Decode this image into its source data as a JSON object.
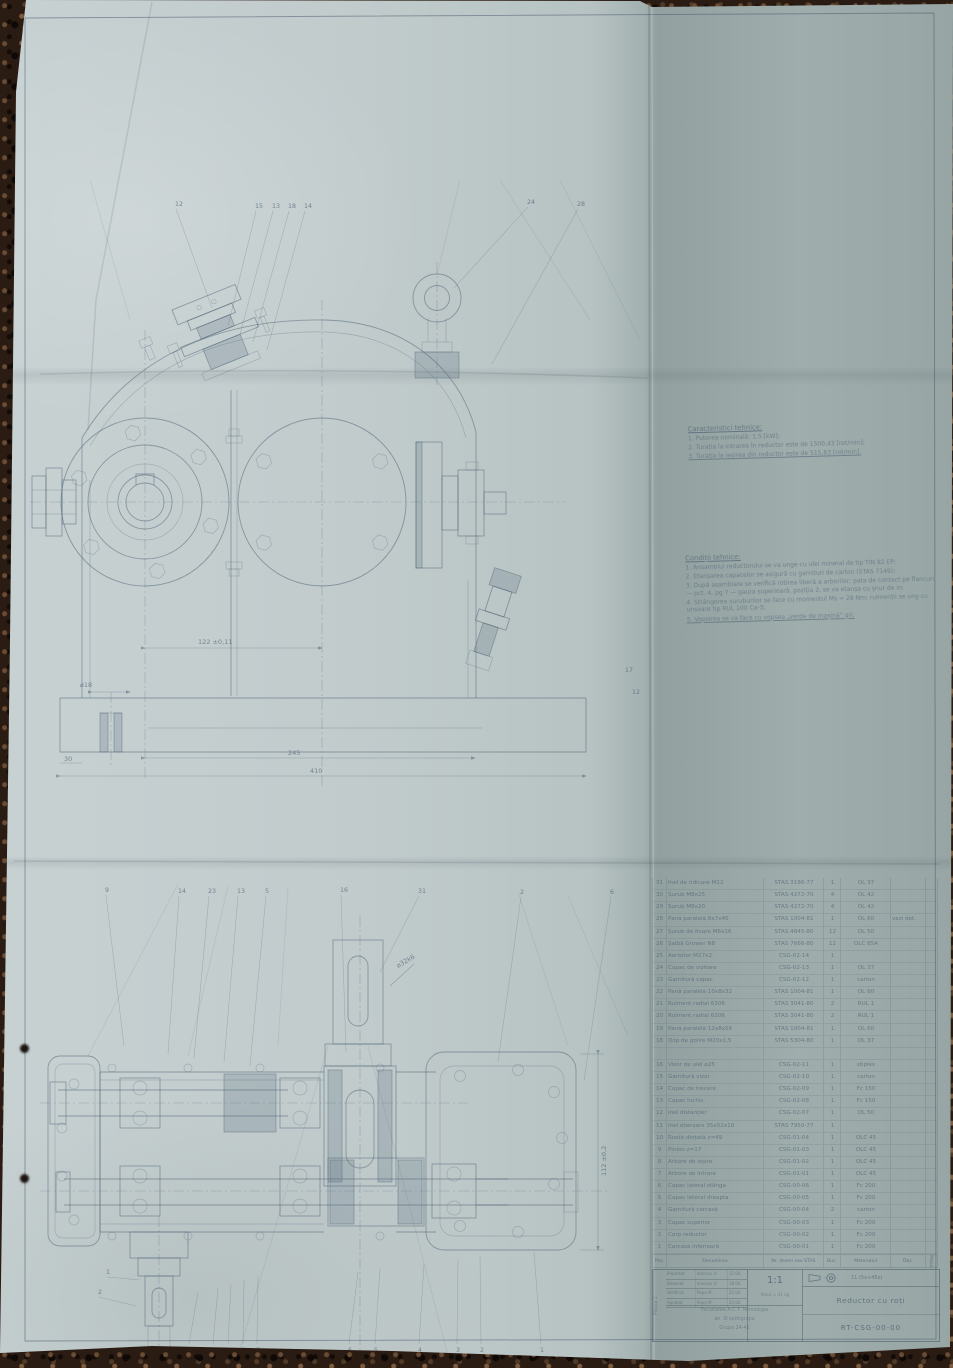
{
  "notes": {
    "characteristics": {
      "title": "Caracteristici tehnice:",
      "items": [
        "1. Puterea nominală: 1,5 [kW];",
        "2. Turația la intrarea în reductor este de 1500,43 [rot/min];",
        "3. Turația la ieșirea din reductor este de 515,63 [rot/min]."
      ]
    },
    "conditions": {
      "title": "Condiții tehnice:",
      "items": [
        "1. Ansamblul reductorului se va unge cu ulei mineral de tip TIN 82 EP;",
        "2. Etanșarea capacelor se asigură cu garnituri de carton (STAS 7149);",
        "3. După asamblare se verifică rotirea liberă a arborilor; pata de contact pe flancuri — pct. 4, pg 7 — gaura superioară, poziția 2, se va etanșa cu șnur de in;",
        "4. Strângerea șuruburilor se face cu momentul Ms = 28 Nm; rulmenții se ung cu unsoare tip RUL 100 Ca-3;",
        "5. Vopsirea se va face cu vopsea „verde de mașină” gri."
      ]
    }
  },
  "front_view": {
    "callouts": [
      {
        "n": "12",
        "x": 145,
        "y": 26,
        "tx": 182,
        "ty": 128
      },
      {
        "n": "15",
        "x": 225,
        "y": 28,
        "tx": 198,
        "ty": 146
      },
      {
        "n": "13",
        "x": 242,
        "y": 28,
        "tx": 210,
        "ty": 154
      },
      {
        "n": "18",
        "x": 258,
        "y": 28,
        "tx": 223,
        "ty": 162
      },
      {
        "n": "14",
        "x": 274,
        "y": 28,
        "tx": 237,
        "ty": 170
      },
      {
        "n": "24",
        "x": 497,
        "y": 24,
        "tx": 424,
        "ty": 108
      },
      {
        "n": "28",
        "x": 547,
        "y": 26,
        "tx": 462,
        "ty": 184
      },
      {
        "n": "17",
        "x": 595,
        "y": 492
      },
      {
        "n": "12",
        "x": 602,
        "y": 514
      }
    ],
    "dims": {
      "center_distance": "122 ±0,11",
      "foot_hole": "⌀18",
      "base_inner": "245",
      "base_total": "410",
      "foot_offset": "30"
    }
  },
  "section_view": {
    "callouts_top": [
      {
        "n": "9",
        "x": 77,
        "y": 16,
        "tx": 96,
        "ty": 170
      },
      {
        "n": "14",
        "x": 150,
        "y": 17,
        "tx": 140,
        "ty": 178
      },
      {
        "n": "23",
        "x": 180,
        "y": 17,
        "tx": 166,
        "ty": 182
      },
      {
        "n": "13",
        "x": 209,
        "y": 17,
        "tx": 196,
        "ty": 186
      },
      {
        "n": "5",
        "x": 237,
        "y": 17,
        "tx": 222,
        "ty": 190
      },
      {
        "n": "16",
        "x": 312,
        "y": 16,
        "tx": 318,
        "ty": 176
      },
      {
        "n": "31",
        "x": 390,
        "y": 17,
        "tx": 352,
        "ty": 96
      },
      {
        "n": "2",
        "x": 492,
        "y": 18,
        "tx": 470,
        "ty": 186
      },
      {
        "n": "6",
        "x": 582,
        "y": 18,
        "tx": 556,
        "ty": 205
      }
    ],
    "callouts_bottom": [
      {
        "n": "11",
        "x": 160,
        "y": 476,
        "dy": -8,
        "tx": 170,
        "ty": 416
      },
      {
        "n": "10",
        "x": 184,
        "y": 476,
        "dy": -8,
        "tx": 190,
        "ty": 412
      },
      {
        "n": "9",
        "x": 199,
        "y": 476,
        "dy": -8,
        "tx": 203,
        "ty": 408
      },
      {
        "n": "8",
        "x": 214,
        "y": 476,
        "dy": -8,
        "tx": 216,
        "ty": 404
      },
      {
        "n": "7",
        "x": 228,
        "y": 476,
        "dy": -8,
        "tx": 230,
        "ty": 400
      },
      {
        "n": "6",
        "x": 320,
        "y": 476,
        "dy": -8,
        "tx": 330,
        "ty": 396
      },
      {
        "n": "5",
        "x": 346,
        "y": 476,
        "dy": -8,
        "tx": 352,
        "ty": 392
      },
      {
        "n": "4",
        "x": 390,
        "y": 476,
        "dy": -8,
        "tx": 396,
        "ty": 388
      },
      {
        "n": "3",
        "x": 428,
        "y": 476,
        "dy": -8,
        "tx": 430,
        "ty": 384
      },
      {
        "n": "2",
        "x": 452,
        "y": 476,
        "dy": -8,
        "tx": 452,
        "ty": 380
      },
      {
        "n": "1",
        "x": 512,
        "y": 476,
        "dy": -8,
        "tx": 506,
        "ty": 376
      }
    ],
    "callouts_side": [
      {
        "n": "1",
        "x": 78,
        "y": 398,
        "tx": 112,
        "ty": 404
      },
      {
        "n": "2",
        "x": 70,
        "y": 418,
        "tx": 108,
        "ty": 430
      }
    ],
    "dims": {
      "shaft_end": "⌀32k6",
      "right_height": "112 ±0,2"
    }
  },
  "parts_table": {
    "header": {
      "poz": "Poz.",
      "name": "Denumirea",
      "std": "Nr. desen sau STAS",
      "qty": "Buc.",
      "mat": "Materialul",
      "obs": "Obs.",
      "extra": "Masa"
    },
    "rows": [
      {
        "poz": "31",
        "name": "Inel de ridicare M12",
        "std": "STAS 3186-77",
        "qty": "1",
        "mat": "OL 37",
        "obs": ""
      },
      {
        "poz": "30",
        "name": "Șurub M8x25",
        "std": "STAS 4272-70",
        "qty": "4",
        "mat": "OL 42",
        "obs": ""
      },
      {
        "poz": "29",
        "name": "Șurub M8x20",
        "std": "STAS 4272-70",
        "qty": "4",
        "mat": "OL 42",
        "obs": ""
      },
      {
        "poz": "28",
        "name": "Pană paralelă 8x7x40",
        "std": "STAS 1004-81",
        "qty": "1",
        "mat": "OL 60",
        "obs": "vezi det."
      },
      {
        "poz": "27",
        "name": "Șurub de fixare M6x16",
        "std": "STAS 4845-80",
        "qty": "12",
        "mat": "OL 50",
        "obs": ""
      },
      {
        "poz": "26",
        "name": "Șaibă Grower N8",
        "std": "STAS 7666-80",
        "qty": "12",
        "mat": "OLC 65A",
        "obs": ""
      },
      {
        "poz": "25",
        "name": "Aerisitor M27x2",
        "std": "CSG-02-14",
        "qty": "1",
        "mat": "",
        "obs": ""
      },
      {
        "poz": "24",
        "name": "Capac de vizitare",
        "std": "CSG-02-13",
        "qty": "1",
        "mat": "OL 37",
        "obs": ""
      },
      {
        "poz": "23",
        "name": "Garnitură capac",
        "std": "CSG-02-12",
        "qty": "1",
        "mat": "carton",
        "obs": ""
      },
      {
        "poz": "22",
        "name": "Pană paralelă 10x8x32",
        "std": "STAS 1004-81",
        "qty": "1",
        "mat": "OL 60",
        "obs": ""
      },
      {
        "poz": "21",
        "name": "Rulment radial 6306",
        "std": "STAS 3041-80",
        "qty": "2",
        "mat": "RUL 1",
        "obs": ""
      },
      {
        "poz": "20",
        "name": "Rulment radial 6206",
        "std": "STAS 3041-80",
        "qty": "2",
        "mat": "RUL 1",
        "obs": ""
      },
      {
        "poz": "19",
        "name": "Pană paralelă 12x8x56",
        "std": "STAS 1004-81",
        "qty": "1",
        "mat": "OL 60",
        "obs": ""
      },
      {
        "poz": "18",
        "name": "Dop de golire M20x1,5",
        "std": "STAS 5304-80",
        "qty": "1",
        "mat": "OL 37",
        "obs": ""
      },
      {
        "poz": "",
        "name": "",
        "std": "",
        "qty": "",
        "mat": "",
        "obs": ""
      },
      {
        "poz": "16",
        "name": "Vizor de ulei ⌀25",
        "std": "CSG-02-11",
        "qty": "1",
        "mat": "stiplex",
        "obs": ""
      },
      {
        "poz": "15",
        "name": "Garnitură vizor",
        "std": "CSG-02-10",
        "qty": "1",
        "mat": "carton",
        "obs": ""
      },
      {
        "poz": "14",
        "name": "Capac de trecere",
        "std": "CSG-02-09",
        "qty": "1",
        "mat": "Fc 150",
        "obs": ""
      },
      {
        "poz": "13",
        "name": "Capac închis",
        "std": "CSG-02-08",
        "qty": "1",
        "mat": "Fc 150",
        "obs": ""
      },
      {
        "poz": "12",
        "name": "Inel distanțier",
        "std": "CSG-02-07",
        "qty": "1",
        "mat": "OL 50",
        "obs": ""
      },
      {
        "poz": "11",
        "name": "Inel etanșare 35x52x10",
        "std": "STAS 7950-77",
        "qty": "1",
        "mat": "",
        "obs": ""
      },
      {
        "poz": "10",
        "name": "Roată dințată z=49",
        "std": "CSG-01-04",
        "qty": "1",
        "mat": "OLC 45",
        "obs": ""
      },
      {
        "poz": "9",
        "name": "Pinion z=17",
        "std": "CSG-01-03",
        "qty": "1",
        "mat": "OLC 45",
        "obs": ""
      },
      {
        "poz": "8",
        "name": "Arbore de ieșire",
        "std": "CSG-01-02",
        "qty": "1",
        "mat": "OLC 45",
        "obs": ""
      },
      {
        "poz": "7",
        "name": "Arbore de intrare",
        "std": "CSG-01-01",
        "qty": "1",
        "mat": "OLC 45",
        "obs": ""
      },
      {
        "poz": "6",
        "name": "Capac lateral stânga",
        "std": "CSG-00-06",
        "qty": "1",
        "mat": "Fc 200",
        "obs": ""
      },
      {
        "poz": "5",
        "name": "Capac lateral dreapta",
        "std": "CSG-00-05",
        "qty": "1",
        "mat": "Fc 200",
        "obs": ""
      },
      {
        "poz": "4",
        "name": "Garnitură carcasă",
        "std": "CSG-00-04",
        "qty": "2",
        "mat": "carton",
        "obs": ""
      },
      {
        "poz": "3",
        "name": "Capac superior",
        "std": "CSG-00-03",
        "qty": "1",
        "mat": "Fc 200",
        "obs": ""
      },
      {
        "poz": "2",
        "name": "Corp reductor",
        "std": "CSG-00-02",
        "qty": "1",
        "mat": "Fc 200",
        "obs": ""
      },
      {
        "poz": "1",
        "name": "Carcasă inferioară",
        "std": "CSG-00-01",
        "qty": "1",
        "mat": "Fc 200",
        "obs": ""
      }
    ]
  },
  "title_block": {
    "sheet_label": "Planșa 1",
    "roles": [
      {
        "label": "Proiectat",
        "name": "Ionescu V.",
        "date": "12.04"
      },
      {
        "label": "Desenat",
        "name": "Ionescu V.",
        "date": "18.04"
      },
      {
        "label": "Verificat",
        "name": "Popa M.",
        "date": "22.04"
      },
      {
        "label": "Aprobat",
        "name": "Popa M.",
        "date": "25.04"
      }
    ],
    "scale": "1:1",
    "mass_note": "Masa ≈ 41 kg",
    "tolerance_note": "11 (5x+45x)",
    "school_lines": [
      "Facultatea A.C.T. Tehnologia",
      "an. III semigrupa",
      "Grupa 24-41"
    ],
    "title": "Reductor cu roți",
    "drawing_number": "RT-CSG-00-00"
  },
  "colors": {
    "paper_light": "#c7d1d2",
    "paper_dark": "#97a6a5",
    "line": "#54687a",
    "carpet": "#2a1c12"
  }
}
